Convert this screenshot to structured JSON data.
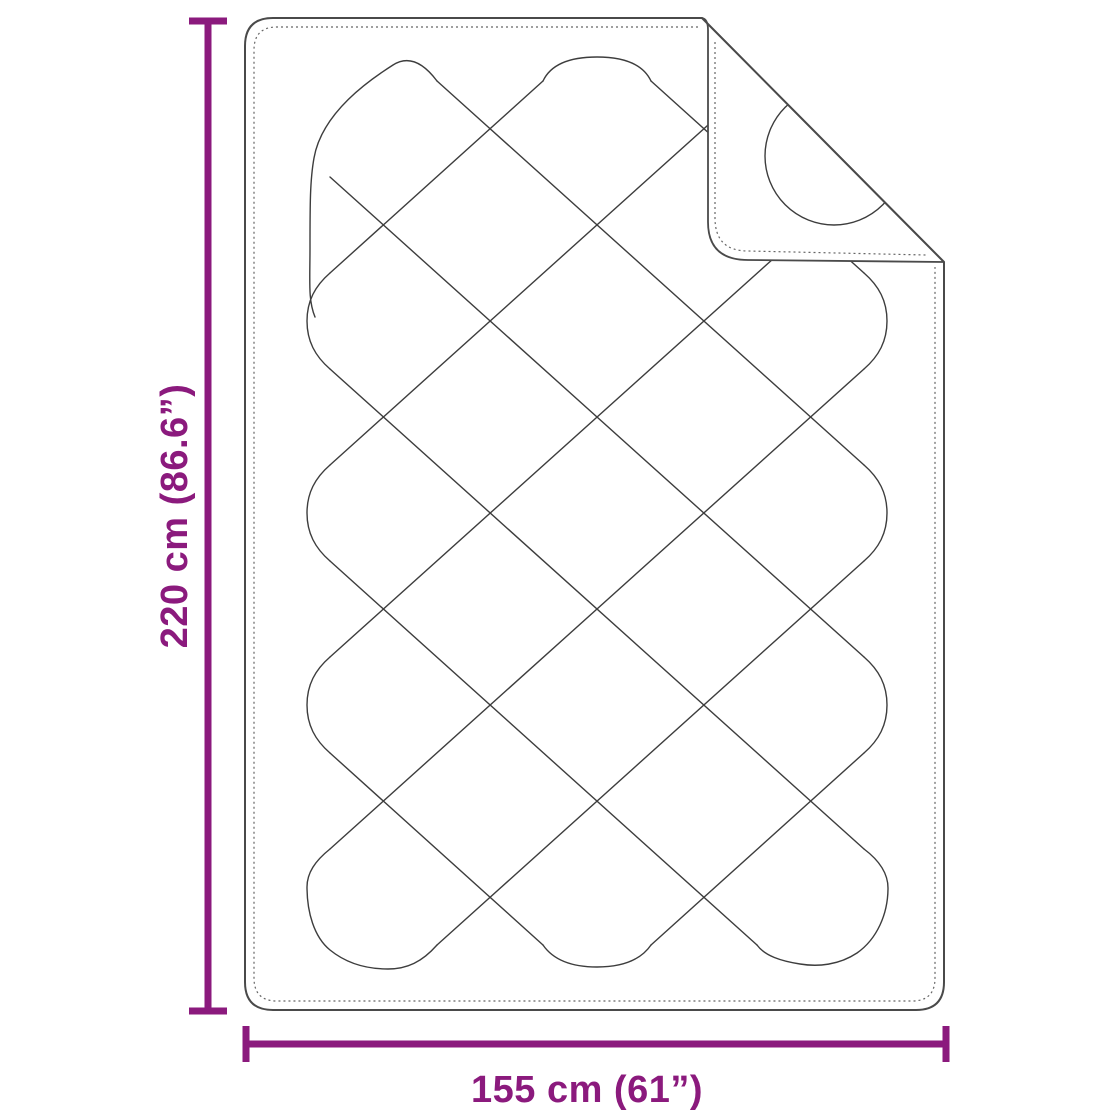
{
  "diagram": {
    "title": "quilted-blanket-dimension-diagram",
    "height_label": "220 cm (86.6”)",
    "width_label": "155 cm (61”)"
  },
  "colors": {
    "dimension": "#8b1a7d",
    "outline": "#4a4a4a",
    "stitch": "#3d3d3d",
    "background": "#ffffff"
  }
}
